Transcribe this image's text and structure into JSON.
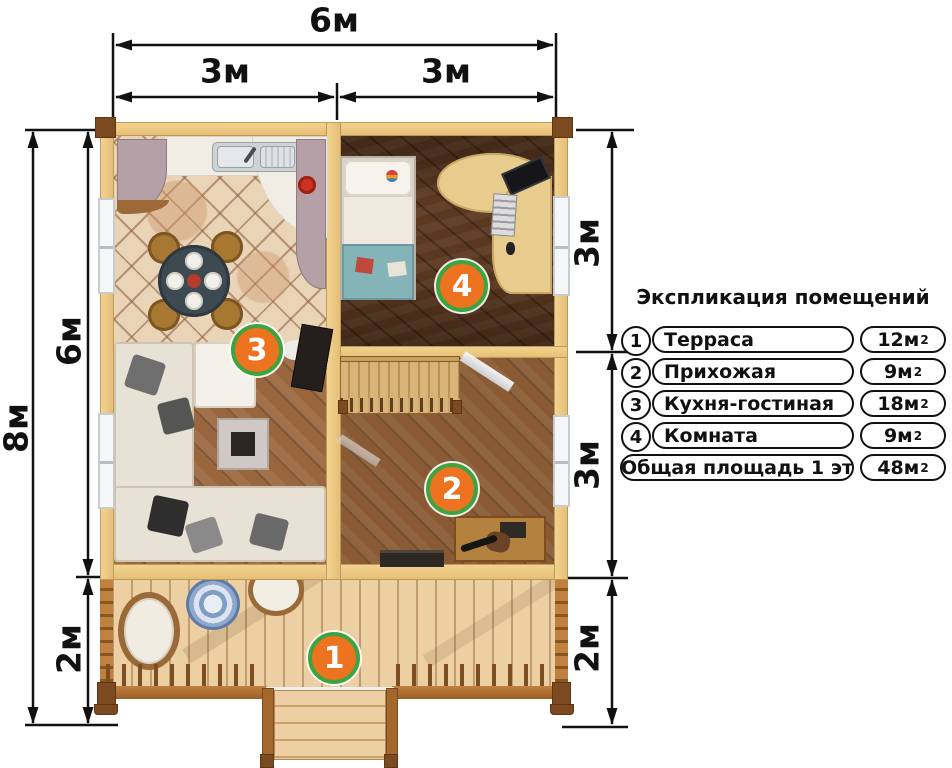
{
  "dimensions": {
    "top_total": "6м",
    "top_left": "3м",
    "top_right": "3м",
    "left_total": "8м",
    "left_upper": "6м",
    "left_lower": "2м",
    "right_upper": "3м",
    "right_lower": "3м",
    "right_bottom": "2м"
  },
  "legend": {
    "title": "Экспликация помещений",
    "rows": [
      {
        "num": "1",
        "name": "Терраса",
        "area_base": "12м",
        "area_exp": "2"
      },
      {
        "num": "2",
        "name": "Прихожая",
        "area_base": "9м",
        "area_exp": "2"
      },
      {
        "num": "3",
        "name": "Кухня-гостиная",
        "area_base": "18м",
        "area_exp": "2"
      },
      {
        "num": "4",
        "name": "Комната",
        "area_base": "9м",
        "area_exp": "2"
      },
      {
        "num": "",
        "name": "Общая площадь 1 эт",
        "area_base": "48м",
        "area_exp": "2"
      }
    ]
  },
  "plan": {
    "badges": [
      {
        "number": "1"
      },
      {
        "number": "2"
      },
      {
        "number": "3"
      },
      {
        "number": "4"
      }
    ],
    "colors": {
      "badge_fill": "#ee7320",
      "badge_ring": "#3fa33f",
      "wall_wood": "#e9c580",
      "dimension_ink": "#111111"
    }
  }
}
